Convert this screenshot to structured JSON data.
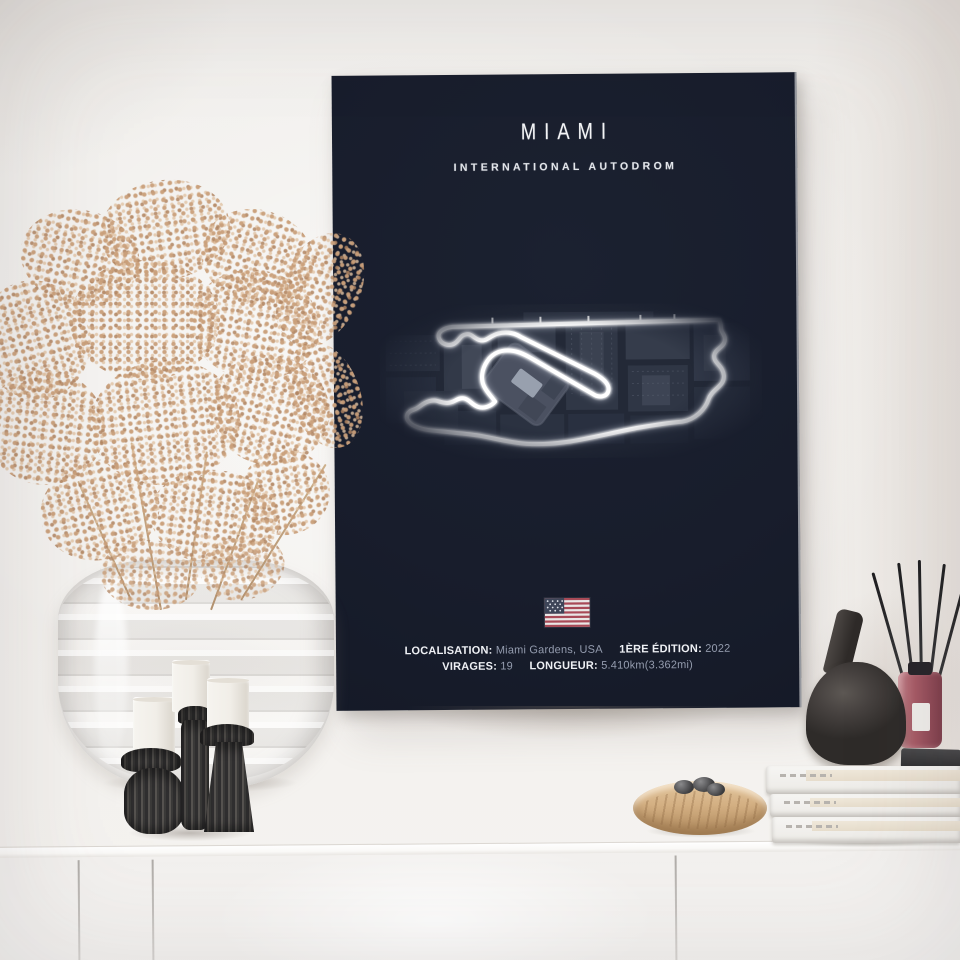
{
  "poster": {
    "title": "MIAMI",
    "subtitle": "INTERNATIONAL AUTODROM",
    "flag_icon": "us-flag",
    "info_line1": {
      "location_label": "LOCALISATION:",
      "location_value": "Miami Gardens, USA",
      "edition_label": "1ÈRE ÉDITION:",
      "edition_value": "2022"
    },
    "info_line2": {
      "turns_label": "VIRAGES:",
      "turns_value": "19",
      "length_label": "LONGUEUR:",
      "length_value": "5.410km(3.362mi)"
    },
    "colors": {
      "poster_bg": "#1a1f2e",
      "track": "#ffffff",
      "flag_red": "#a84a57",
      "flag_canton": "#3e4558",
      "dim_text": "#949cae"
    }
  }
}
